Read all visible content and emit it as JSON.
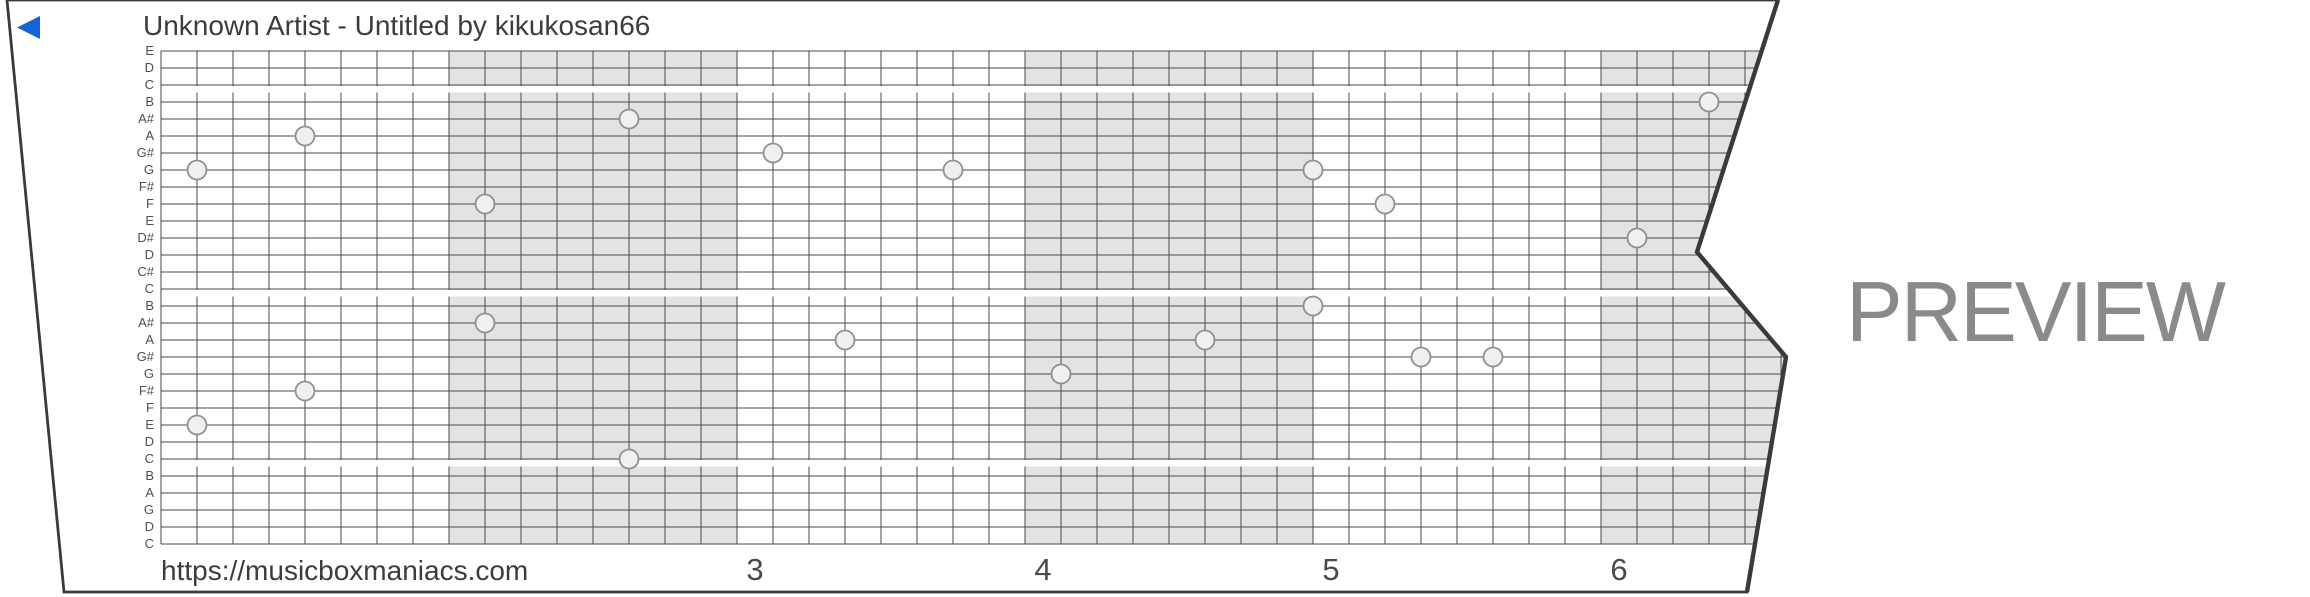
{
  "header": {
    "title": "Unknown Artist - Untitled by kikukosan66"
  },
  "footer": {
    "url": "https://musicboxmaniacs.com"
  },
  "watermark": {
    "text": "PREVIEW",
    "color": "#8a8a8a"
  },
  "colors": {
    "accent_blue": "#1563d6",
    "paper": "#ffffff",
    "grid_line": "#4a4a4a",
    "strip_border": "#3a3a3a",
    "measure_shading": "#e3e3e3",
    "note_fill": "#f0f0f0",
    "note_stroke": "#909090",
    "text": "#3c3c3c",
    "label_text": "#4f4f4f",
    "watermark_text": "#8a8a8a"
  },
  "strip": {
    "outline": [
      [
        7,
        0
      ],
      [
        1778,
        0
      ],
      [
        1697,
        252
      ],
      [
        1786,
        357
      ],
      [
        1747,
        592
      ],
      [
        64,
        592
      ]
    ],
    "grid": {
      "x": 161,
      "y": 51,
      "col_width": 36,
      "row_height": 17,
      "rows": 30,
      "cols": 46
    },
    "note_labels": [
      "E",
      "D",
      "C",
      "B",
      "A#",
      "A",
      "G#",
      "G",
      "F#",
      "F",
      "E",
      "D#",
      "D",
      "C#",
      "C",
      "B",
      "A#",
      "A",
      "G#",
      "G",
      "F#",
      "F",
      "E",
      "D",
      "C",
      "B",
      "A",
      "G",
      "D",
      "C"
    ],
    "group_breaks_after_rows": [
      2,
      14,
      24
    ],
    "shaded_measures": [
      {
        "from_col": 8,
        "to_col": 16
      },
      {
        "from_col": 24,
        "to_col": 32
      },
      {
        "from_col": 40,
        "to_col": 48
      }
    ],
    "measure_numbers": [
      {
        "label": "3",
        "col": 16
      },
      {
        "label": "4",
        "col": 24
      },
      {
        "label": "5",
        "col": 32
      },
      {
        "label": "6",
        "col": 40
      }
    ],
    "notes": [
      {
        "pitch": "B",
        "row": 3,
        "col": 43
      },
      {
        "pitch": "A#",
        "row": 4,
        "col": 13
      },
      {
        "pitch": "A",
        "row": 5,
        "col": 4
      },
      {
        "pitch": "G#",
        "row": 6,
        "col": 17
      },
      {
        "pitch": "G",
        "row": 7,
        "col": 1
      },
      {
        "pitch": "G",
        "row": 7,
        "col": 22
      },
      {
        "pitch": "G",
        "row": 7,
        "col": 32
      },
      {
        "pitch": "F",
        "row": 9,
        "col": 9
      },
      {
        "pitch": "F",
        "row": 9,
        "col": 34
      },
      {
        "pitch": "D#",
        "row": 11,
        "col": 41
      },
      {
        "pitch": "B",
        "row": 15,
        "col": 32
      },
      {
        "pitch": "A#",
        "row": 16,
        "col": 9
      },
      {
        "pitch": "A",
        "row": 17,
        "col": 19
      },
      {
        "pitch": "A",
        "row": 17,
        "col": 29
      },
      {
        "pitch": "G#",
        "row": 18,
        "col": 35
      },
      {
        "pitch": "G#",
        "row": 18,
        "col": 37
      },
      {
        "pitch": "G",
        "row": 19,
        "col": 25
      },
      {
        "pitch": "F#",
        "row": 20,
        "col": 4
      },
      {
        "pitch": "E",
        "row": 22,
        "col": 1
      },
      {
        "pitch": "C",
        "row": 24,
        "col": 13
      }
    ]
  }
}
